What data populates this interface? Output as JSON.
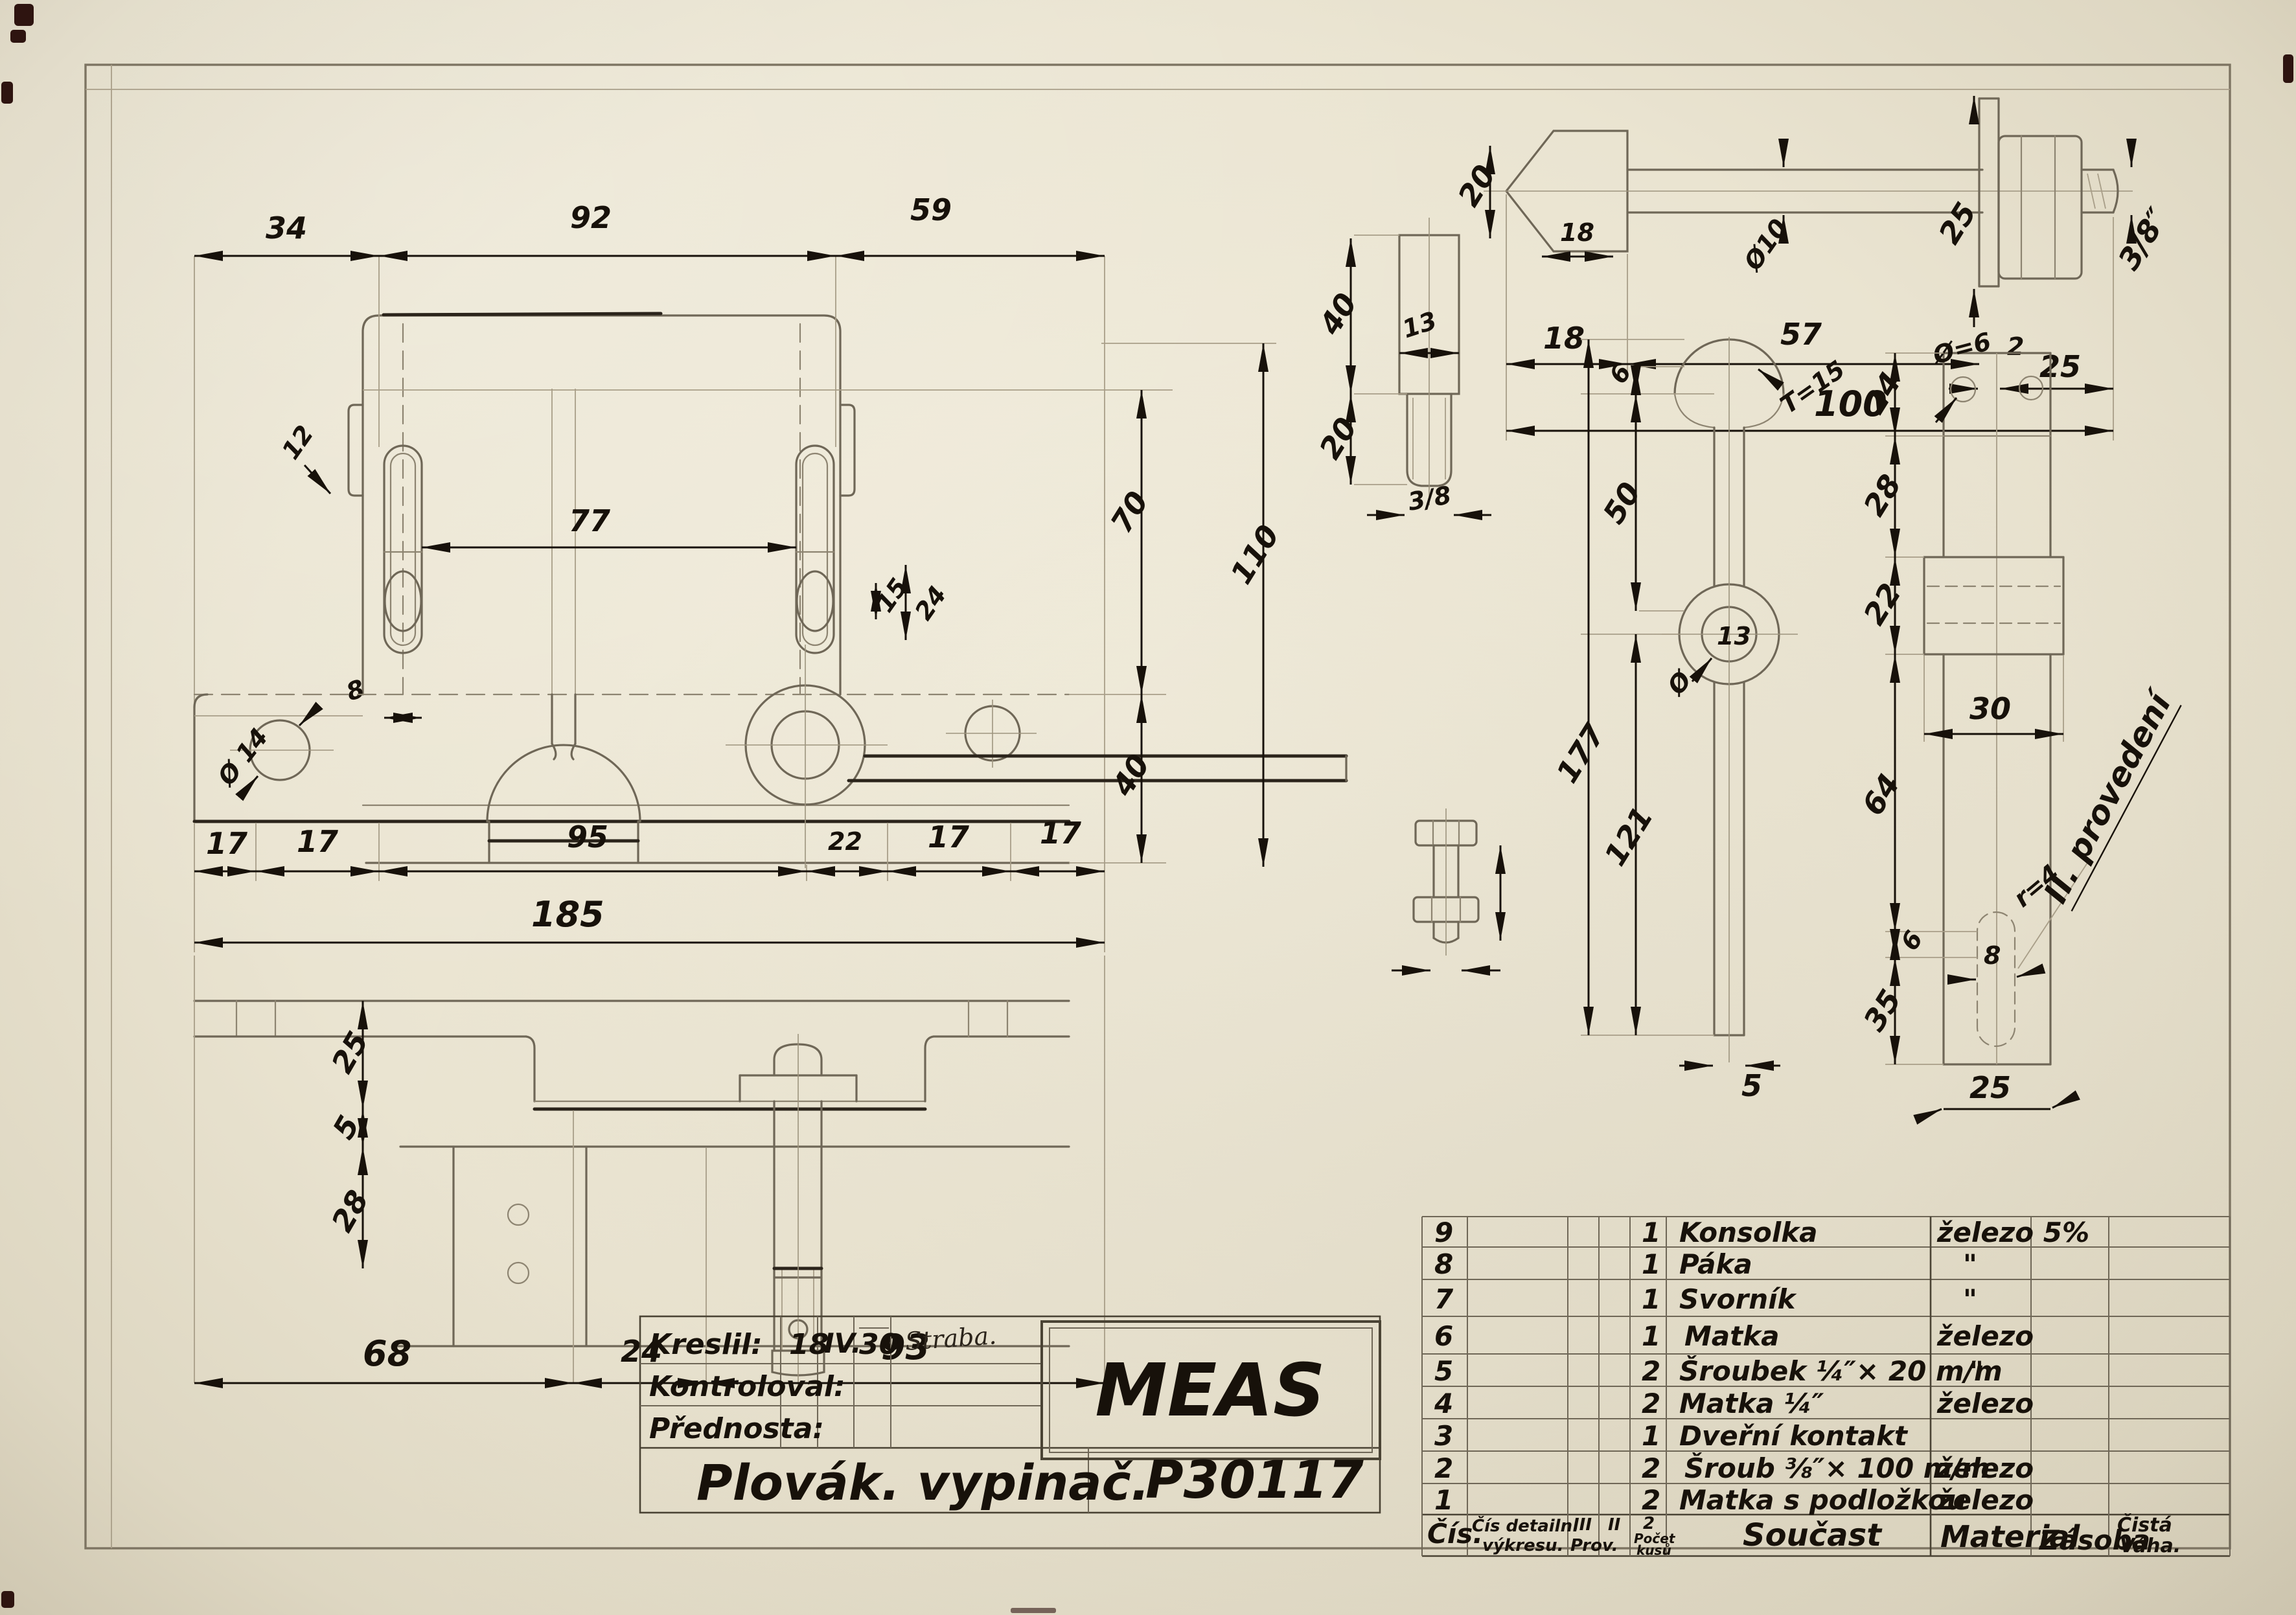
{
  "title_block": {
    "kreslil_label": "Kreslil:",
    "kreslil_day": "18",
    "kreslil_month": "IV.",
    "kreslil_year": "30",
    "kreslil_signature": "Straba.",
    "kontroloval_label": "Kontroloval:",
    "prednosta_label": "Přednosta:",
    "company": "MEAS",
    "title": "Plovák. vypinač.",
    "drawing_number": "P30117"
  },
  "parts_table": {
    "headers": {
      "cis": "Čís.",
      "detail_line1": "Čís detailn.",
      "detail_line2": "výkresu.",
      "prov3": "III",
      "prov3_sub": "Prov.",
      "prov2": "II",
      "qty_top": "2",
      "qty_sub1": "Počet",
      "qty_sub2": "kusů",
      "name": "Součast",
      "material": "Material",
      "zasoba": "Zásoba",
      "vaha_line1": "Čistá",
      "vaha_line2": "Váha."
    },
    "rows": [
      {
        "num": "9",
        "qty": "1",
        "name": "Konsolka",
        "material": "železo 5%"
      },
      {
        "num": "8",
        "qty": "1",
        "name": "Páka",
        "material": "\""
      },
      {
        "num": "7",
        "qty": "1",
        "name": "Svorník",
        "material": "\""
      },
      {
        "num": "6",
        "qty": "1",
        "name": "Matka",
        "material": "železo"
      },
      {
        "num": "5",
        "qty": "2",
        "name": "Šroubek ¼″× 20 m/m",
        "material": "\""
      },
      {
        "num": "4",
        "qty": "2",
        "name": "Matka ¼″",
        "material": "železo"
      },
      {
        "num": "3",
        "qty": "1",
        "name": "Dveřní kontakt",
        "material": ""
      },
      {
        "num": "2",
        "qty": "2",
        "name": "Šroub ⅜″× 100 m/m",
        "material": "železo"
      },
      {
        "num": "1",
        "qty": "2",
        "name": "Matka s podložkou",
        "material": "železo"
      }
    ]
  },
  "annotations": {
    "provedeni": "II. provedení"
  },
  "dims": {
    "top_34": "34",
    "top_92": "92",
    "top_59": "59",
    "slot_77": "77",
    "slot_15": "15",
    "slot_24": "24",
    "tab_12": "12",
    "slot_8": "8",
    "hole_dia14": "Ø 14",
    "right_70": "70",
    "right_110": "110",
    "right_40": "40",
    "front_17a": "17",
    "front_17b": "17",
    "front_95": "95",
    "front_22": "22",
    "front_17c": "17",
    "front_17d": "17",
    "front_185": "185",
    "bottom_25": "25",
    "bottom_5": "5",
    "bottom_28": "28",
    "bottom_68": "68",
    "bottom_24": "24",
    "bottom_93": "93",
    "bolt_20": "20",
    "bolt_dia10": "Ø10",
    "bolt_25": "25",
    "bolt_38": "3/8″",
    "bolt_18": "18",
    "bolt_57": "57",
    "bolt_2": "2",
    "bolt_25b": "25",
    "bolt_100": "100",
    "stud_40": "40",
    "stud_20": "20",
    "stud_13": "13",
    "stud_38": "3/8",
    "misc_18": "18",
    "lever_6": "6",
    "lever_50": "50",
    "lever_r15": "T=15",
    "lever_dia": "Ø",
    "lever_13": "13",
    "lever_177": "177",
    "lever_121": "121",
    "lever_5": "5",
    "bracket_dia6": "Ø=6",
    "bracket_24": "24",
    "bracket_28": "28",
    "bracket_22": "22",
    "bracket_30": "30",
    "bracket_64": "64",
    "bracket_6": "6",
    "bracket_35": "35",
    "bracket_8": "8",
    "bracket_r4": "r=4",
    "bracket_25": "25"
  }
}
